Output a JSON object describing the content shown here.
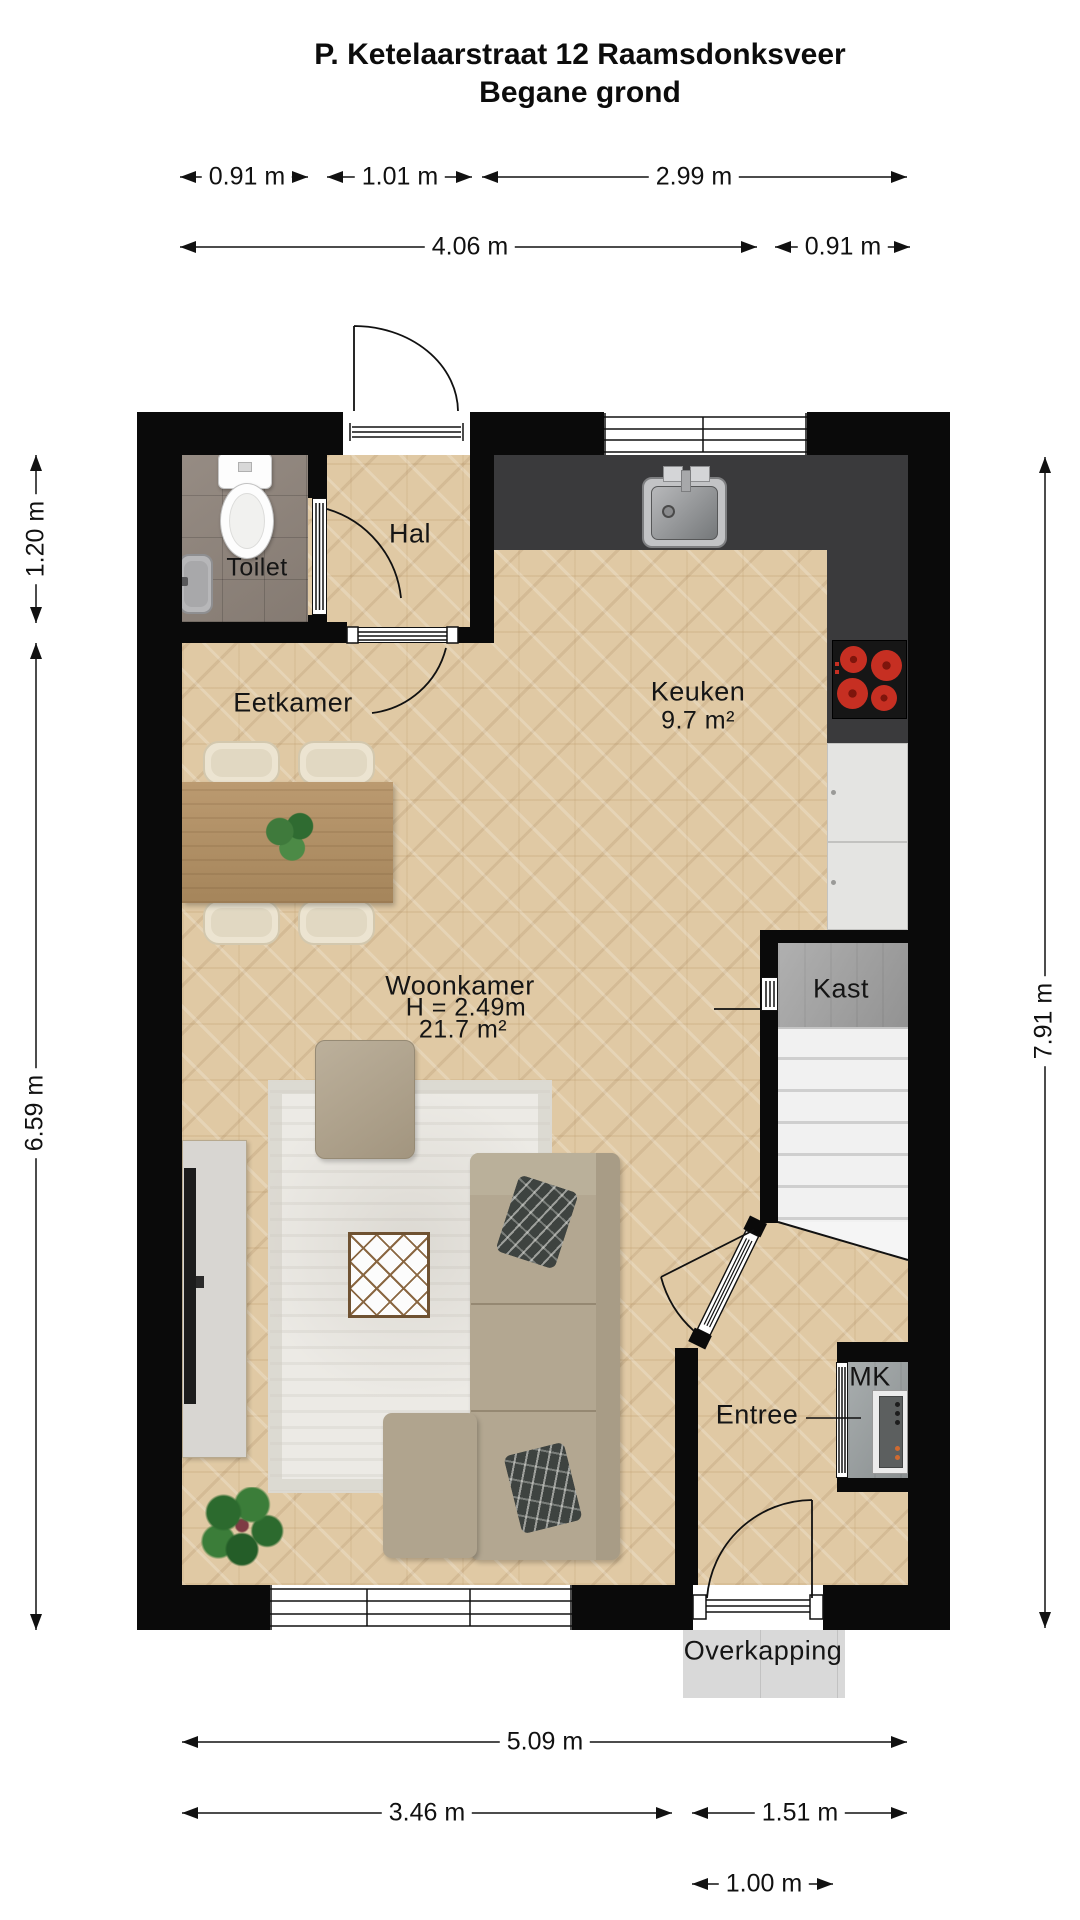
{
  "title": {
    "line1": "P. Ketelaarstraat 12 Raamsdonksveer",
    "line2": "Begane grond"
  },
  "rooms": {
    "hal": "Hal",
    "toilet": "Toilet",
    "eetkamer": "Eetkamer",
    "keuken": {
      "name": "Keuken",
      "area": "9.7 m²"
    },
    "woonkamer": {
      "name": "Woonkamer",
      "height": "H = 2.49m",
      "area": "21.7 m²"
    },
    "kast": "Kast",
    "entree": "Entree",
    "mk": "MK",
    "overkapping": "Overkapping"
  },
  "dimensions": {
    "top_row1": {
      "a": "0.91 m",
      "b": "1.01 m",
      "c": "2.99 m"
    },
    "top_row2": {
      "a": "4.06 m",
      "b": "0.91 m"
    },
    "left": {
      "a": "1.20 m",
      "b": "6.59 m"
    },
    "right": {
      "a": "7.91 m"
    },
    "bottom_row1": {
      "a": "5.09 m"
    },
    "bottom_row2": {
      "a": "3.46 m",
      "b": "1.51 m"
    },
    "bottom_row3": {
      "a": "1.00 m"
    }
  },
  "colors": {
    "wall": "#0a0a0a",
    "wood_floor": "#e0c9a4",
    "kitchen_counter": "#3a3a3c",
    "toilet_tiles": "#8d8279",
    "burner_red": "#c62f22"
  }
}
